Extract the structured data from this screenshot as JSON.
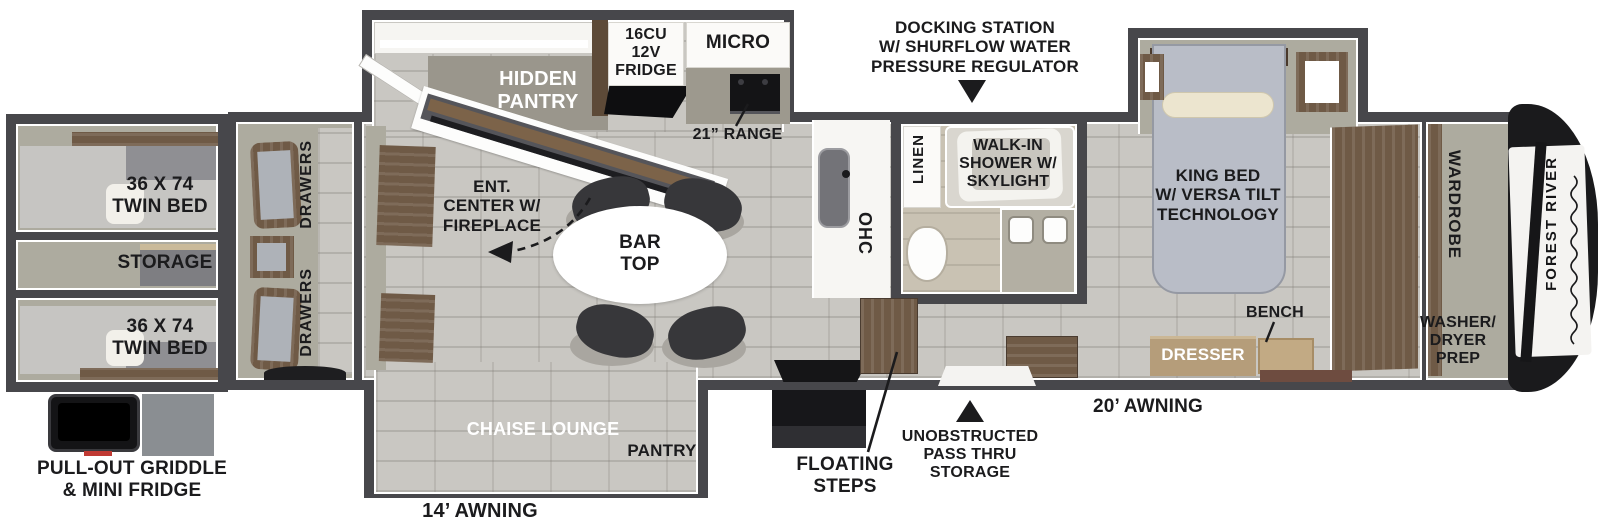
{
  "bunkhouse": {
    "twin_bed_top": "36 X 74\nTWIN BED",
    "storage": "STORAGE",
    "twin_bed_bottom": "36 X 74\nTWIN BED",
    "drawers_top": "DRAWERS",
    "drawers_bottom": "DRAWERS"
  },
  "kitchen": {
    "hidden_pantry": "HIDDEN\nPANTRY",
    "fridge": "16CU\n12V\nFRIDGE",
    "micro": "MICRO",
    "range": "21” RANGE"
  },
  "living": {
    "ent_center": "ENT.\nCENTER W/\nFIREPLACE",
    "bar_top": "BAR\nTOP",
    "ohc": "OHC",
    "chaise_lounge": "CHAISE LOUNGE",
    "pantry": "PANTRY"
  },
  "bathroom": {
    "linen": "LINEN",
    "shower": "WALK-IN\nSHOWER W/\nSKYLIGHT"
  },
  "bedroom": {
    "king_bed": "KING BED\nW/ VERSA TILT\nTECHNOLOGY",
    "bench": "BENCH",
    "dresser": "DRESSER",
    "wardrobe": "WARDROBE",
    "washer_dryer": "WASHER/\nDRYER\nPREP"
  },
  "exterior": {
    "docking_station": "DOCKING STATION\nW/ SHURFLOW WATER\nPRESSURE REGULATOR",
    "floating_steps": "FLOATING\nSTEPS",
    "pass_thru": "UNOBSTRUCTED\nPASS THRU\nSTORAGE",
    "awning_curbside": "14’ AWNING",
    "awning_front": "20’ AWNING",
    "griddle": "PULL-OUT GRIDDLE\n& MINI FRIDGE",
    "brand": "FOREST RIVER"
  },
  "colors": {
    "wall": "#47474b",
    "tile_floor": "#c9c7c2",
    "room_warm_gray": "#adab9f",
    "wood": "#6f5a46",
    "tan_upholstery": "#b59d7a",
    "king_bed": "#b9bdc7",
    "label_text": "#1b1b1d",
    "background": "#ffffff"
  }
}
